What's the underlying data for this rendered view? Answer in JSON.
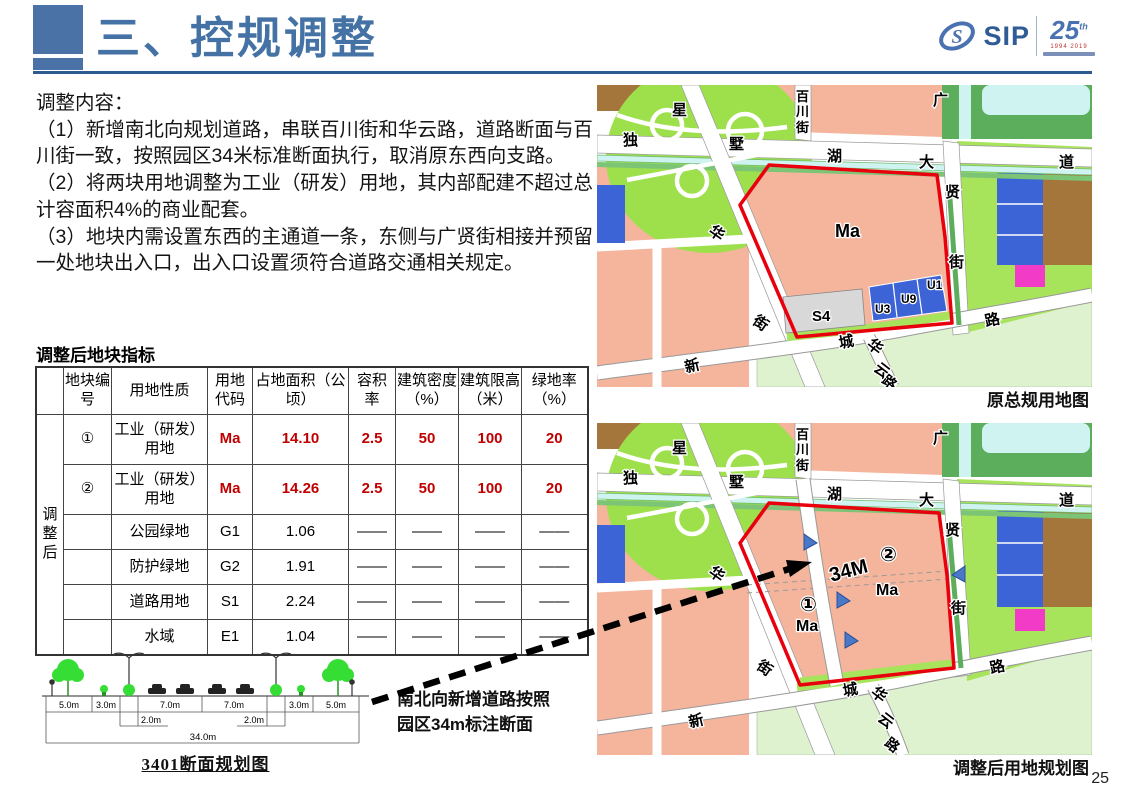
{
  "page": {
    "number": "25"
  },
  "header": {
    "title": "三、控规调整"
  },
  "logo": {
    "sip": "SIP",
    "s_mark": "S",
    "anniversary": "25",
    "anniversary_suffix": "th",
    "years": "1994 2019"
  },
  "content": {
    "heading": "调整内容：",
    "items": [
      "（1）新增南北向规划道路，串联百川街和华云路，道路断面与百川街一致，按照园区34米标准断面执行，取消原东西向支路。",
      "（2）将两块用地调整为工业（研发）用地，其内部配建不超过总计容面积4%的商业配套。",
      "（3）地块内需设置东西的主通道一条，东侧与广贤街相接并预留一处地块出入口，出入口设置须符合道路交通相关规定。"
    ]
  },
  "table": {
    "title": "调整后地块指标",
    "group_label": "调整后",
    "headers": [
      "地块编号",
      "用地性质",
      "用地代码",
      "占地面积（公顷）",
      "容积率",
      "建筑密度（%）",
      "建筑限高（米）",
      "绿地率（%）"
    ],
    "rows": [
      {
        "id": "①",
        "nature": "工业（研发）用地",
        "code": "Ma",
        "area": "14.10",
        "far": "2.5",
        "density": "50",
        "height": "100",
        "green": "20"
      },
      {
        "id": "②",
        "nature": "工业（研发）用地",
        "code": "Ma",
        "area": "14.26",
        "far": "2.5",
        "density": "50",
        "height": "100",
        "green": "20"
      },
      {
        "id": "",
        "nature": "公园绿地",
        "code": "G1",
        "area": "1.06",
        "far": "——",
        "density": "——",
        "height": "——",
        "green": "——"
      },
      {
        "id": "",
        "nature": "防护绿地",
        "code": "G2",
        "area": "1.91",
        "far": "——",
        "density": "——",
        "height": "——",
        "green": "——"
      },
      {
        "id": "",
        "nature": "道路用地",
        "code": "S1",
        "area": "2.24",
        "far": "——",
        "density": "——",
        "height": "——",
        "green": "——"
      },
      {
        "id": "",
        "nature": "水域",
        "code": "E1",
        "area": "1.04",
        "far": "——",
        "density": "——",
        "height": "——",
        "green": "——"
      }
    ]
  },
  "section": {
    "dims": [
      "5.0m",
      "3.0m",
      "7.0m",
      "7.0m",
      "3.0m",
      "5.0m"
    ],
    "sub_dims": [
      "2.0m",
      "2.0m"
    ],
    "total": "34.0m",
    "caption": "3401断面规划图"
  },
  "annotation": {
    "line1": "南北向新增道路按照",
    "line2": "园区34m标注断面"
  },
  "maps": {
    "original": {
      "caption": "原总规用地图",
      "labels": {
        "xing": "星",
        "du": "独",
        "shu": "墅",
        "bai": "百",
        "chuan": "川",
        "jie1": "街",
        "hu": "湖",
        "da": "大",
        "guang": "广",
        "dao": "道",
        "xian": "贤",
        "jie2": "街",
        "hua1": "华",
        "jie3": "街",
        "ma": "Ma",
        "s4": "S4",
        "u3": "U3",
        "u9": "U9",
        "u1": "U1",
        "xin": "新",
        "cheng": "城",
        "hua2": "华",
        "yun": "云",
        "lu1": "路",
        "lu2": "路"
      }
    },
    "adjusted": {
      "caption": "调整后用地规划图",
      "labels": {
        "xing": "星",
        "du": "独",
        "shu": "墅",
        "bai": "百",
        "chuan": "川",
        "jie1": "街",
        "hu": "湖",
        "da": "大",
        "guang": "广",
        "dao": "道",
        "xian": "贤",
        "jie2": "街",
        "hua1": "华",
        "jie3": "街",
        "xin": "新",
        "cheng": "城",
        "hua2": "华",
        "yun": "云",
        "lu1": "路",
        "lu2": "路",
        "label34m": "34M",
        "num1": "①",
        "ma1": "Ma",
        "num2": "②",
        "ma2": "Ma"
      }
    }
  },
  "colors": {
    "accent_blue": "#4472A4",
    "rule_blue": "#2E5B8E",
    "table_red": "#C00000",
    "map_salmon": "#F4B59C",
    "map_green_bright": "#9EE04C",
    "map_green_mid": "#5CAD5C",
    "map_green_light": "#A8E35C",
    "map_green_pale": "#DFF2D0",
    "map_cyan": "#CFF3F1",
    "map_blue": "#3C64D7",
    "map_brown": "#A5763B",
    "map_magenta": "#F23CC8",
    "red_outline": "#E8000D"
  }
}
